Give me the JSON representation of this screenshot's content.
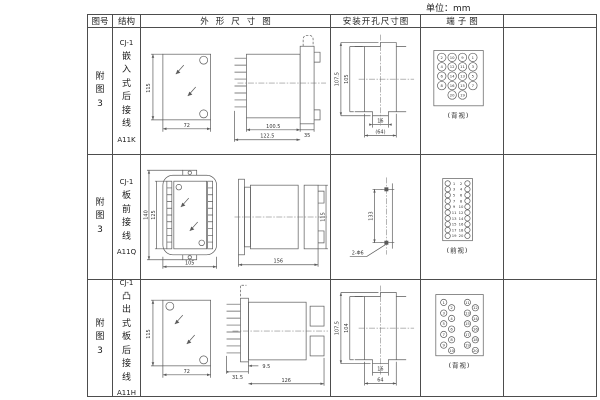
{
  "unit_label": "单位：mm",
  "header": {
    "col_fig": "图号",
    "col_struct": "结构",
    "col_outline": "外形尺寸图",
    "col_install": "安装开孔尺寸图",
    "col_terminal": "端子图"
  },
  "rows": [
    {
      "fig": "附图3",
      "code": "CJ-1",
      "name": "嵌入式后接线",
      "model": "A11K",
      "dims": {
        "front_h": "115",
        "front_w": "72",
        "body": "100.5",
        "flange": "35",
        "total": "122.5",
        "inst_outer": "107.5",
        "inst_inner": "105",
        "inst_notch": "16",
        "inst_span": "(64)"
      },
      "terminal_label": "(背视)"
    },
    {
      "fig": "附图3",
      "code": "CJ-1",
      "name": "板前接线",
      "model": "A11Q",
      "dims": {
        "front_h": "140",
        "front_inner": "125",
        "front_w": "105",
        "side_l": "156",
        "side_h": "115",
        "hole_pitch": "133",
        "hole_note": "2-Φ6"
      },
      "terminal_label": "(前视)"
    },
    {
      "fig": "附图3",
      "code": "CJ-1",
      "name": "凸出式板后接线",
      "model": "A11H",
      "dims": {
        "front_h": "115",
        "front_w": "72",
        "pin": "31.5",
        "step": "9.5",
        "body": "126",
        "inst_outer": "107.5",
        "inst_inner": "104",
        "inst_notch": "16",
        "inst_span": "64"
      },
      "terminal_label": "(背视)"
    }
  ],
  "terminals": {
    "r1": {
      "cols": [
        21,
        31.5,
        42,
        52.5
      ],
      "rows": [
        29,
        38.5,
        48,
        57.5
      ],
      "nums": [
        [
          "2",
          "10",
          "9",
          "1"
        ],
        [
          "4",
          "12",
          "11",
          "3"
        ],
        [
          "6",
          "14",
          "13",
          "5"
        ],
        [
          "8",
          "16",
          "15",
          "7"
        ]
      ],
      "extra": {
        "y": 67,
        "cols": [
          31.5,
          42
        ],
        "nums": [
          "20",
          "19"
        ]
      },
      "r": 4.3
    },
    "r2": {
      "rows": [
        28,
        33.9,
        39.8,
        45.7,
        51.6,
        57.5,
        63.4,
        69.3,
        75.2,
        81.1
      ],
      "cx_left": 27,
      "cx_right": 47,
      "nx_left": 33.5,
      "nx_right": 40.5,
      "left": [
        "1",
        "3",
        "5",
        "7",
        "9",
        "11",
        "13",
        "15",
        "17",
        "19"
      ],
      "right": [
        "2",
        "4",
        "6",
        "8",
        "10",
        "12",
        "14",
        "16",
        "18",
        "20"
      ],
      "r": 2.7
    },
    "r3": {
      "clusters": [
        {
          "x1": 23,
          "x2": 31,
          "y0": 22,
          "dy": 5.4,
          "nums": [
            "1",
            "2",
            "3",
            "4",
            "5",
            "6",
            "7",
            "8",
            "9",
            "10"
          ]
        },
        {
          "x1": 47,
          "x2": 55,
          "y0": 22,
          "dy": 5.4,
          "nums": [
            "11",
            "12",
            "13",
            "14",
            "15",
            "16",
            "17",
            "18",
            "19",
            "20"
          ]
        }
      ],
      "r": 3.2
    }
  }
}
